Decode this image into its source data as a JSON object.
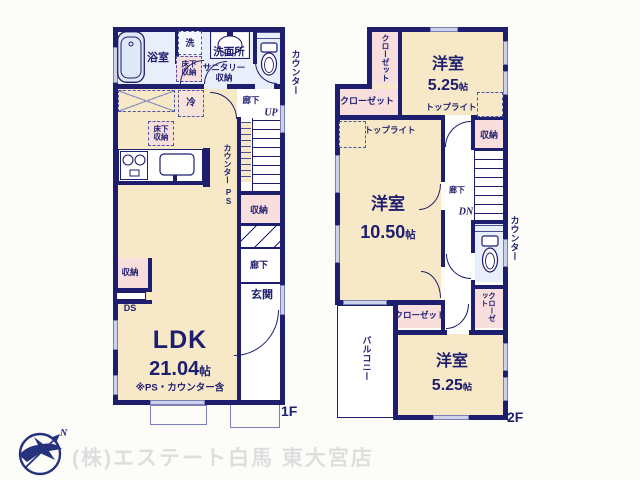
{
  "floor1": {
    "floor_label": "1F",
    "bath": "浴室",
    "laundry": "洗",
    "washroom": "洗面所",
    "sanitary_line1": "サニタリー",
    "sanitary_line2": "収納",
    "underfloor_wash_line1": "床下",
    "underfloor_wash_line2": "収納",
    "underfloor_ldk_line1": "床下",
    "underfloor_ldk_line2": "収納",
    "fridge": "冷",
    "counter_outside": "カウンター",
    "hall_upper": "廊下",
    "up": "UP",
    "counter_kitchen": "カウンター",
    "ps": "PS",
    "storage_hall": "収納",
    "hall_lower": "廊下",
    "entrance": "玄関",
    "storage_ldk": "収納",
    "ds": "DS",
    "ldk": "LDK",
    "ldk_num": "21.04",
    "ldk_unit": "帖",
    "ldk_note": "※PS・カウンター含"
  },
  "floor2": {
    "floor_label": "2F",
    "closet_tl": "クローゼット",
    "closet_tm": "クローゼット",
    "room_top": "洋室",
    "room_top_num": "5.25",
    "room_top_unit": "帖",
    "toplight_r": "トップライト",
    "toplight_l": "トップライト",
    "room_mid": "洋室",
    "room_mid_num": "10.50",
    "room_mid_unit": "帖",
    "storage": "収納",
    "hall": "廊下",
    "dn": "DN",
    "counter_outside": "カウンター",
    "closet_br": "クローゼット",
    "closet_bm": "クローゼット",
    "balcony": "バルコニー",
    "room_bot": "洋室",
    "room_bot_num": "5.25",
    "room_bot_unit": "帖"
  },
  "footer": {
    "company": "(株)エステート白馬 東大宮店",
    "compass_n": "N"
  },
  "colors": {
    "wall": "#1e1e6e",
    "room_cream": "#f7e9c8",
    "storage_pink": "#f9dede",
    "wet_blue": "#e9effa",
    "logo_navy": "#27327f",
    "watermark_gray": "#dedede"
  }
}
